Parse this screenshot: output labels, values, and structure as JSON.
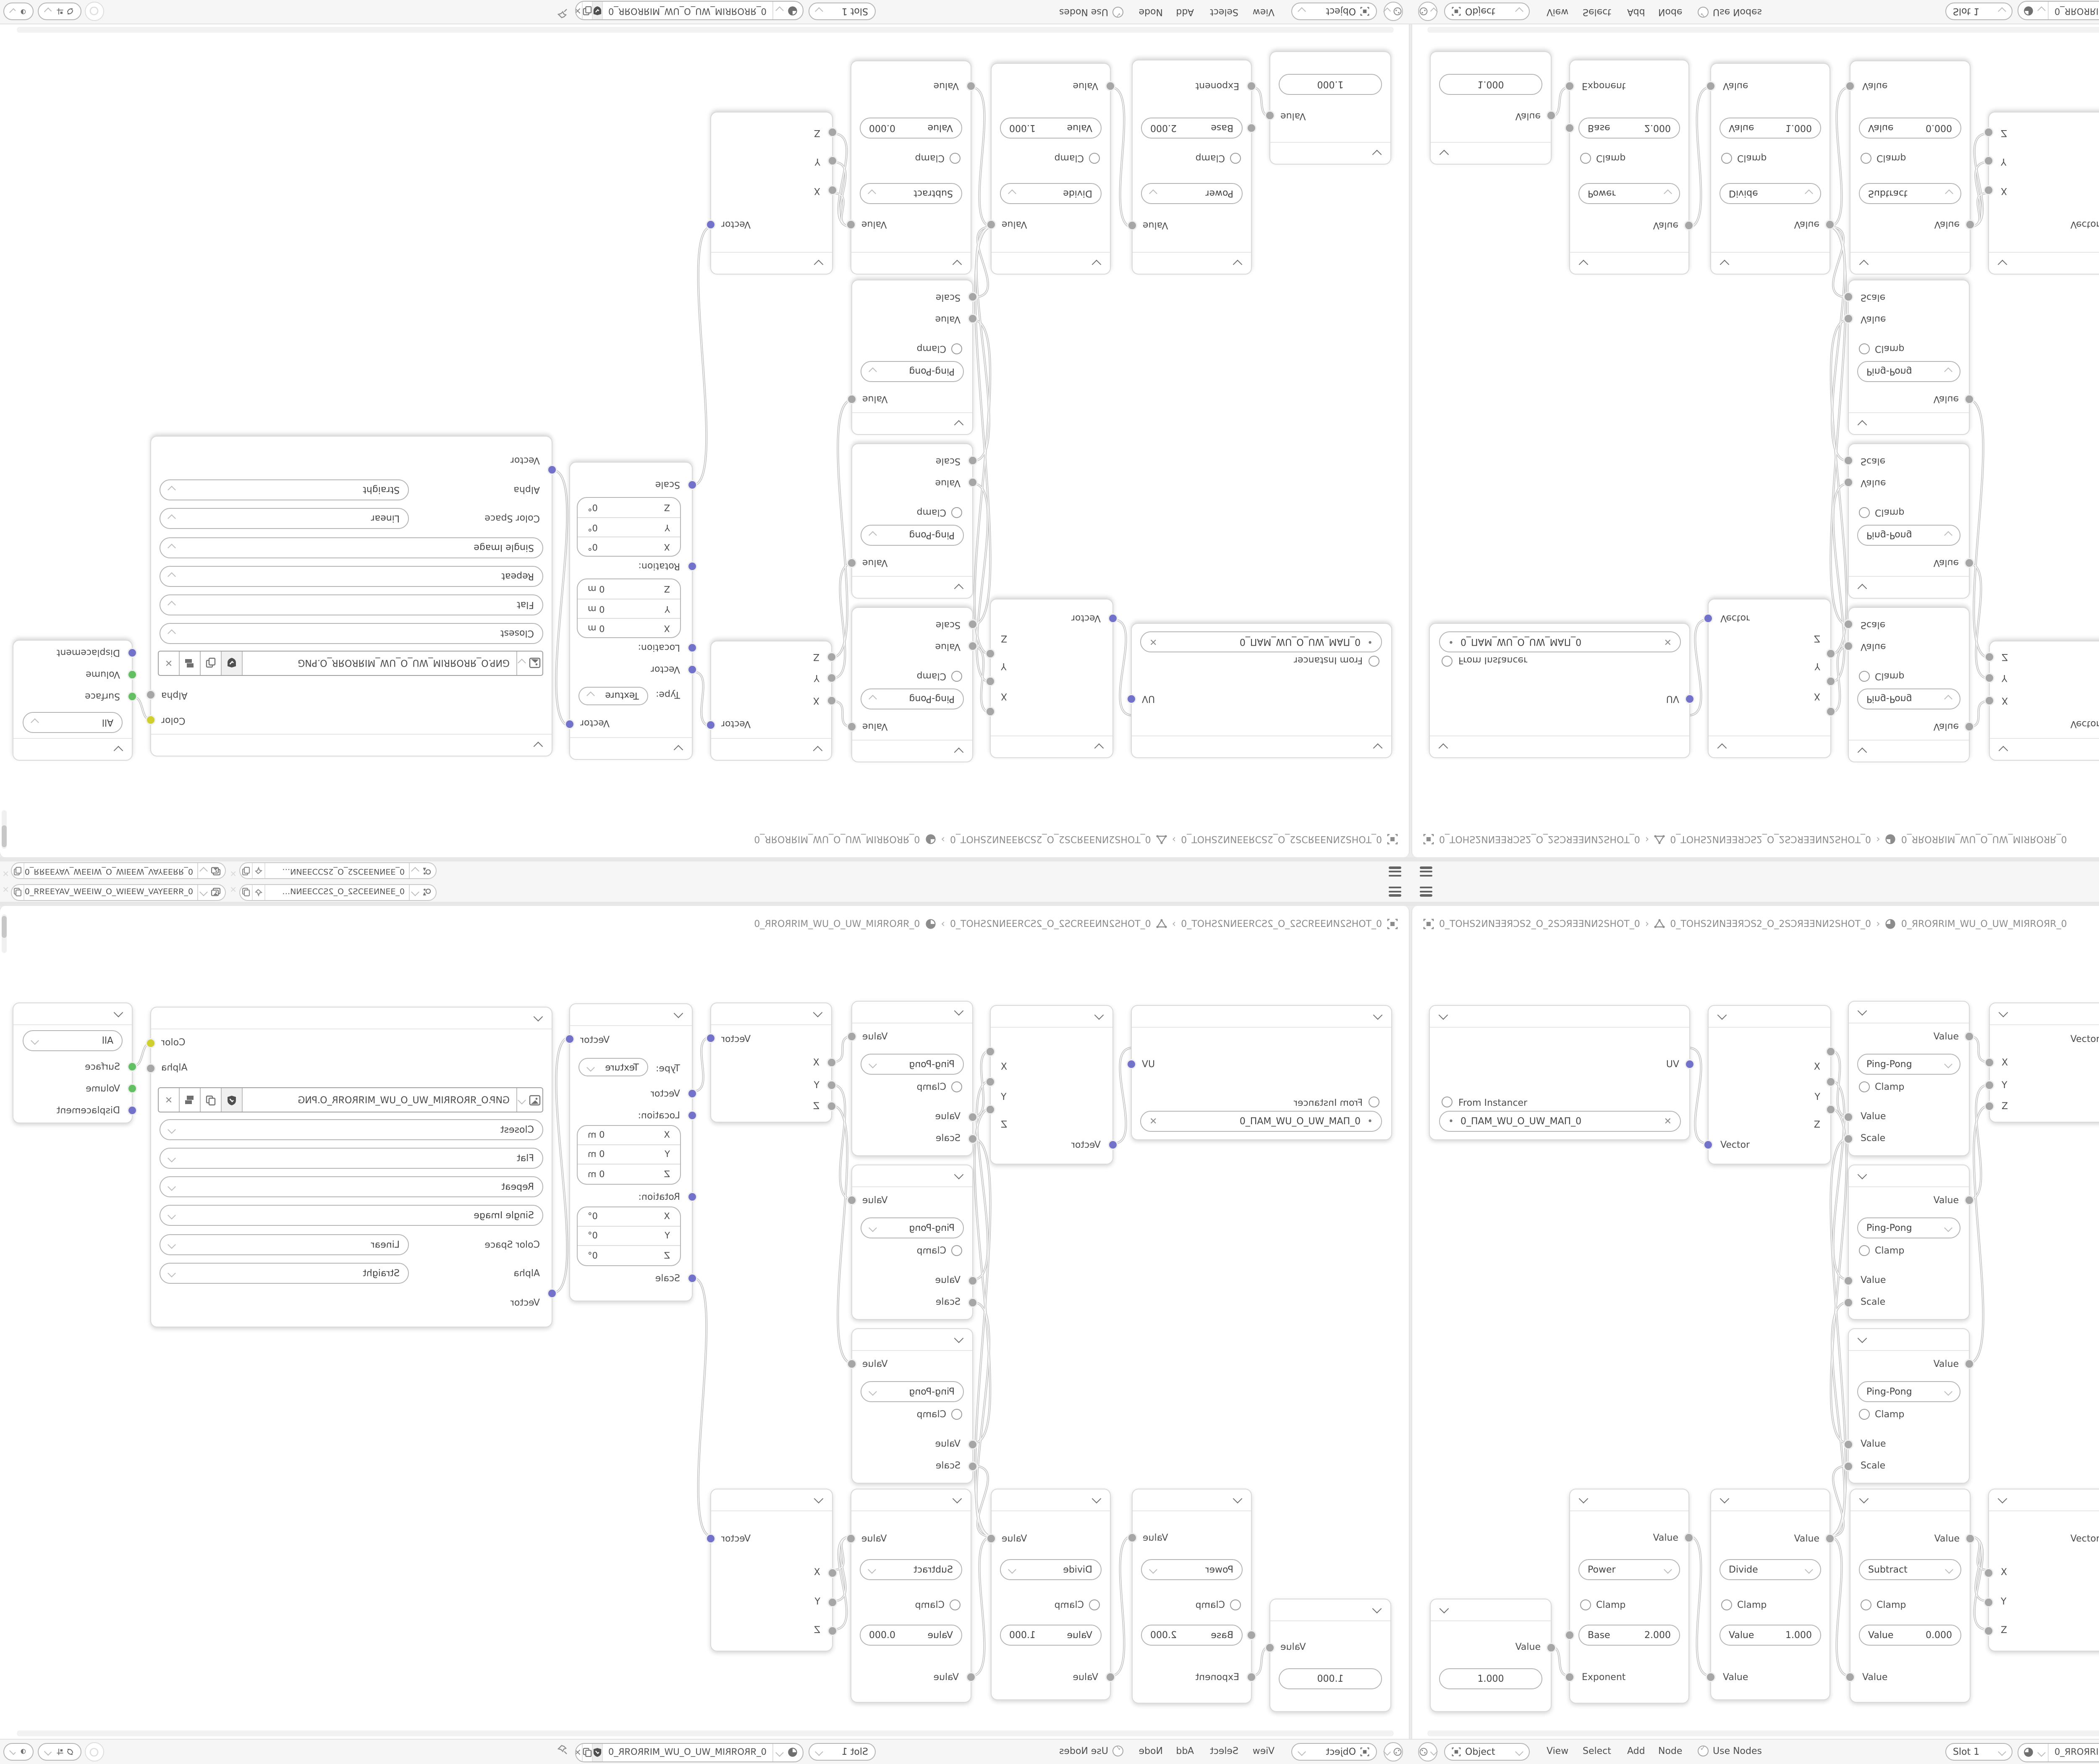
{
  "colors": {
    "canvas": "#ffffff",
    "bar_bg": "#f6f6f6",
    "area_gap": "#e7e7e7",
    "socket_vector": "#7272ca",
    "socket_value": "#a6a6a6",
    "socket_color": "#cfcf2e",
    "socket_shader": "#62c062",
    "wire": "#c2c2c2"
  },
  "topbar": {
    "scene": {
      "name": "0_ƎƎИNƎƎƆS2_O_2SƆƆƎƎNИ…"
    },
    "view_layer": {
      "name": "0_ЯЯƎƎYAV_WƎƎIW_O_WIƎƎW_VAYƎƎЯЯ_0"
    },
    "close_glyph": "✕"
  },
  "breadcrumb": {
    "object": "0_TOHS2ИNƎƎЯƆS2_O_2SƆЯƎƎNИ2SHOT_0",
    "mesh": "0_TOHS2ИNƎƎЯƆS2_O_2SƆЯƎƎNИ2SHOT_0",
    "material": "0_ЯROЯRIM_WU_O_UW_MIЯROЯR_0",
    "separator": "›"
  },
  "nodes": {
    "uv_map": {
      "output": "UV",
      "from_instancer": "From Instancer",
      "uv_name": "0_ПAM_WU_O_UW_MAП_0",
      "clear_glyph": "✕",
      "dot_glyph": "•"
    },
    "separate_xyz": {
      "x": "X",
      "y": "Y",
      "z": "Z",
      "vector": "Vector"
    },
    "pingpong": {
      "output": "Value",
      "operation": "Ping-Pong",
      "clamp": "Clamp",
      "value": "Value",
      "scale": "Scale"
    },
    "combine_xyz": {
      "vector": "Vector",
      "x": "X",
      "y": "Y",
      "z": "Z"
    },
    "mapping": {
      "output": "Vector",
      "type_label": "Type:",
      "type_value": "Texture",
      "vector": "Vector",
      "location": "Location:",
      "rotation": "Rotation:",
      "scale": "Scale",
      "loc_rows": [
        {
          "axis": "X",
          "value": "0 m"
        },
        {
          "axis": "Y",
          "value": "0 m"
        },
        {
          "axis": "Z",
          "value": "0 m"
        }
      ],
      "rot_rows": [
        {
          "axis": "X",
          "value": "0°"
        },
        {
          "axis": "Y",
          "value": "0°"
        },
        {
          "axis": "Z",
          "value": "0°"
        }
      ]
    },
    "image_texture": {
      "color": "Color",
      "alpha": "Alpha",
      "filename": "GИP.O_ЯROЯRIM_WU_O_UW_MIЯROЯR_O.PNG",
      "interpolation": "Closest",
      "projection": "Flat",
      "extension": "Repeat",
      "source": "Single Image",
      "color_space_label": "Color Space",
      "color_space": "Linear",
      "alpha_label": "Alpha",
      "alpha_mode": "Straight",
      "vector": "Vector",
      "clear_glyph": "✕"
    },
    "output": {
      "target": "All",
      "surface": "Surface",
      "volume": "Volume",
      "displacement": "Displacement"
    },
    "value": {
      "output": "Value",
      "value": "1.000"
    },
    "power": {
      "output": "Value",
      "operation": "Power",
      "clamp": "Clamp",
      "base_label": "Base",
      "base_value": "2.000",
      "exponent": "Exponent"
    },
    "divide": {
      "output": "Value",
      "operation": "Divide",
      "clamp": "Clamp",
      "value_label": "Value",
      "value": "1.000",
      "input": "Value"
    },
    "subtract": {
      "output": "Value",
      "operation": "Subtract",
      "clamp": "Clamp",
      "value_label": "Value",
      "value": "0.000",
      "input": "Value"
    }
  },
  "header": {
    "shader_type": "Object",
    "menus": [
      "View",
      "Select",
      "Add",
      "Node"
    ],
    "use_nodes": "Use Nodes",
    "slot": "Slot 1",
    "material": "0_ЯROЯRIM_WU_O_UW_MIЯROЯR_0"
  }
}
